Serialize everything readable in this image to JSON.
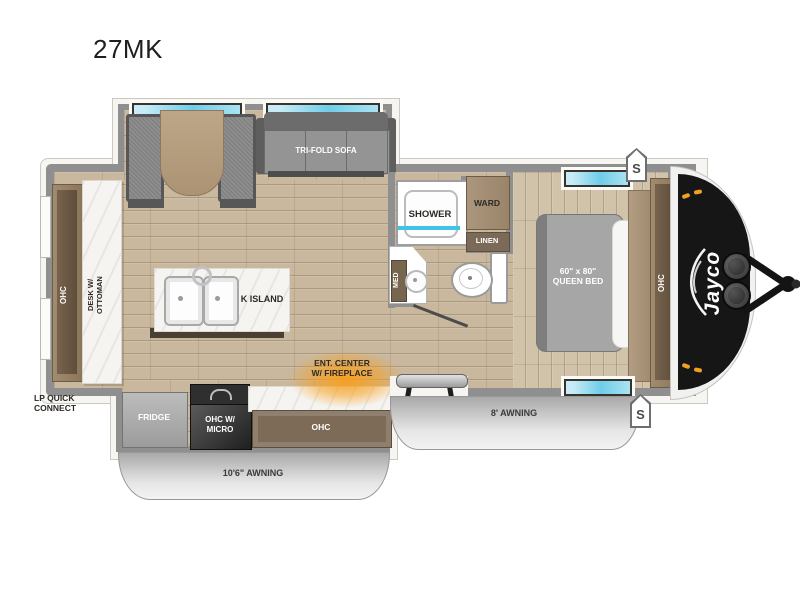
{
  "title": "27MK",
  "colors": {
    "wall": "#8f8f8f",
    "floor_wood": "#c9b89e",
    "marble": "#f5f4f0",
    "cabinet_wood": "#97826a",
    "window_glass": "#6fcde9",
    "awning_gray": "#c9c9c9",
    "front_cap_black": "#161616",
    "fireplace_glow": "#f89e1b",
    "marker_light_amber": "#f2a024"
  },
  "labels": {
    "sofa": "TRI-FOLD SOFA",
    "rear_ohc": "OHC",
    "desk": "DESK W/\nOTTOMAN",
    "lp": "LP QUICK\nCONNECT",
    "island": "K ISLAND",
    "shower": "SHOWER",
    "ward": "WARD",
    "linen": "LINEN",
    "med": "MED",
    "bed": "60\" x 80\"\nQUEEN BED",
    "front_ohc": "OHC",
    "brand": "Jayco",
    "fridge": "FRIDGE",
    "micro": "OHC W/\nMICRO",
    "kitchen_ohc": "OHC",
    "ent": "ENT. CENTER\nW/ FIREPLACE",
    "awning_kitchen": "10'6\" AWNING",
    "awning_door": "8' AWNING",
    "speaker": "S"
  }
}
